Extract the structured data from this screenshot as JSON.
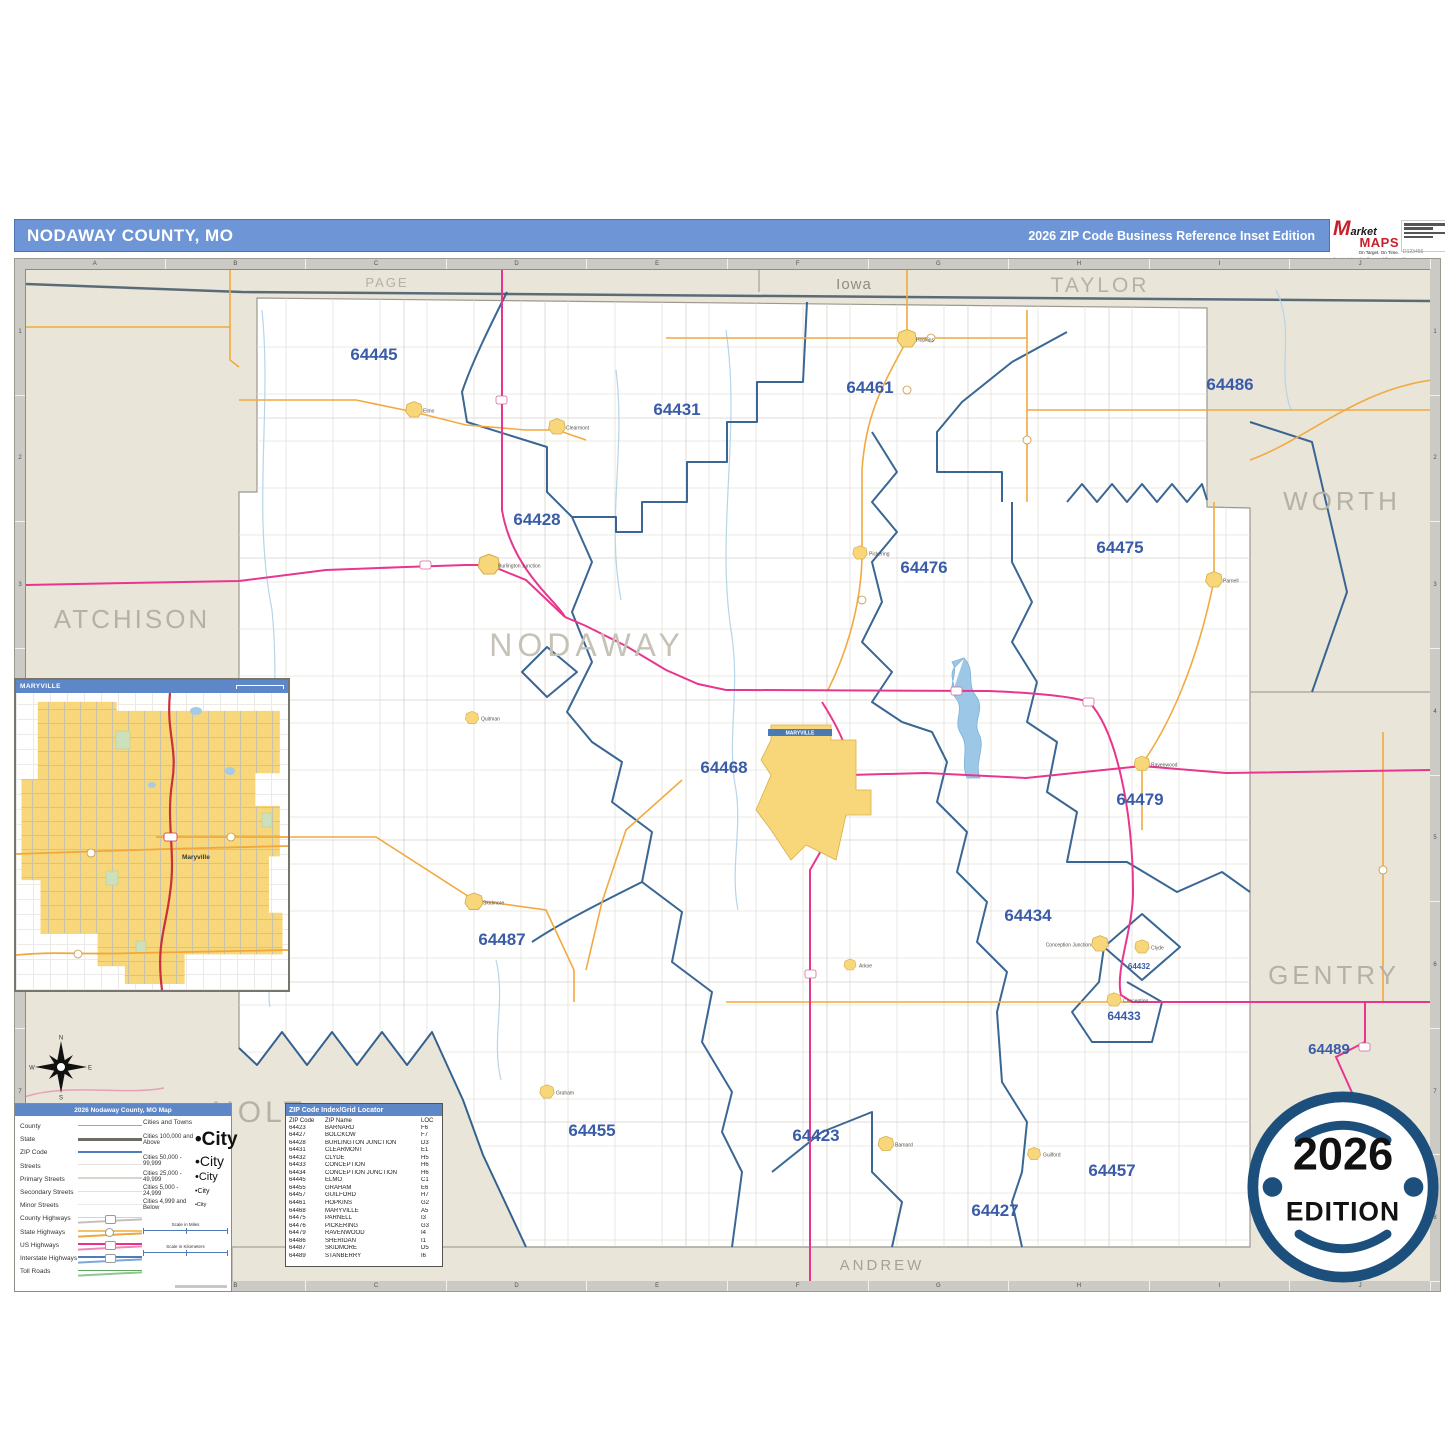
{
  "header": {
    "title": "NODAWAY COUNTY, MO",
    "edition": "2026 ZIP Code Business Reference Inset Edition",
    "logo": {
      "m": "M",
      "arket": "arket",
      "maps": "MAPS",
      "tagline": "On Target.  On Time.",
      "subline": "America's Leading Source of Business Maps",
      "order_code": "D123456"
    }
  },
  "ruler": {
    "letters": [
      "A",
      "B",
      "C",
      "D",
      "E",
      "F",
      "G",
      "H",
      "I",
      "J"
    ],
    "numbers": [
      "1",
      "2",
      "3",
      "4",
      "5",
      "6",
      "7",
      "8"
    ]
  },
  "map": {
    "maryville_label": "MARYVILLE",
    "county_labels": [
      {
        "text": "PAGE",
        "x": 361,
        "y": 17,
        "size": 13,
        "color": "#B5B1A5",
        "ls": 2
      },
      {
        "text": "Iowa",
        "x": 828,
        "y": 19,
        "size": 15,
        "color": "#8F8C83",
        "ls": 1
      },
      {
        "text": "TAYLOR",
        "x": 1074,
        "y": 22,
        "size": 21,
        "color": "#B5B1A5",
        "ls": 3
      },
      {
        "text": "WORTH",
        "x": 1316,
        "y": 240,
        "size": 26,
        "color": "#B5B1A5",
        "ls": 4
      },
      {
        "text": "ATCHISON",
        "x": 106,
        "y": 358,
        "size": 26,
        "color": "#B5B1A5",
        "ls": 3
      },
      {
        "text": "NODAWAY",
        "x": 561,
        "y": 386,
        "size": 32,
        "color": "#C6C2B6",
        "ls": 5
      },
      {
        "text": "GENTRY",
        "x": 1308,
        "y": 714,
        "size": 26,
        "color": "#B5B1A5",
        "ls": 4
      },
      {
        "text": "HOLT",
        "x": 233,
        "y": 852,
        "size": 30,
        "color": "#B5B1A5",
        "ls": 4
      },
      {
        "text": "ANDREW",
        "x": 856,
        "y": 1000,
        "size": 15,
        "color": "#A5A196",
        "ls": 3
      }
    ],
    "zip_labels": [
      {
        "code": "64445",
        "x": 348,
        "y": 90,
        "size": 17
      },
      {
        "code": "64431",
        "x": 651,
        "y": 145,
        "size": 17
      },
      {
        "code": "64461",
        "x": 844,
        "y": 123,
        "size": 17
      },
      {
        "code": "64486",
        "x": 1204,
        "y": 120,
        "size": 17
      },
      {
        "code": "64428",
        "x": 511,
        "y": 255,
        "size": 17
      },
      {
        "code": "64476",
        "x": 898,
        "y": 303,
        "size": 17
      },
      {
        "code": "64475",
        "x": 1094,
        "y": 283,
        "size": 17
      },
      {
        "code": "64468",
        "x": 698,
        "y": 503,
        "size": 17
      },
      {
        "code": "64479",
        "x": 1114,
        "y": 535,
        "size": 17
      },
      {
        "code": "64487",
        "x": 476,
        "y": 675,
        "size": 17
      },
      {
        "code": "64434",
        "x": 1002,
        "y": 651,
        "size": 17
      },
      {
        "code": "64432",
        "x": 1113,
        "y": 699,
        "size": 8
      },
      {
        "code": "64433",
        "x": 1098,
        "y": 750,
        "size": 12
      },
      {
        "code": "64489",
        "x": 1303,
        "y": 784,
        "size": 15
      },
      {
        "code": "64455",
        "x": 566,
        "y": 866,
        "size": 17
      },
      {
        "code": "64423",
        "x": 790,
        "y": 871,
        "size": 17
      },
      {
        "code": "64457",
        "x": 1086,
        "y": 906,
        "size": 17
      },
      {
        "code": "64427",
        "x": 969,
        "y": 946,
        "size": 17
      }
    ],
    "towns": [
      {
        "name": "Hopkins",
        "x": 881,
        "y": 69,
        "s": 1.6
      },
      {
        "name": "Elmo",
        "x": 388,
        "y": 140,
        "s": 1.4
      },
      {
        "name": "Clearmont",
        "x": 531,
        "y": 157,
        "s": 1.4
      },
      {
        "name": "Burlington Junction",
        "x": 463,
        "y": 295,
        "s": 1.8
      },
      {
        "name": "Quitman",
        "x": 446,
        "y": 448,
        "s": 1.1
      },
      {
        "name": "Pickering",
        "x": 834,
        "y": 283,
        "s": 1.2
      },
      {
        "name": "Parnell",
        "x": 1188,
        "y": 310,
        "s": 1.4
      },
      {
        "name": "Ravenwood",
        "x": 1116,
        "y": 494,
        "s": 1.3
      },
      {
        "name": "Skidmore",
        "x": 448,
        "y": 632,
        "s": 1.5
      },
      {
        "name": "Arkoe",
        "x": 824,
        "y": 695,
        "s": 1.0
      },
      {
        "name": "Conception Junction",
        "x": 1074,
        "y": 674,
        "s": 1.4,
        "side": "left"
      },
      {
        "name": "Clyde",
        "x": 1116,
        "y": 677,
        "s": 1.2
      },
      {
        "name": "Conception",
        "x": 1088,
        "y": 730,
        "s": 1.2
      },
      {
        "name": "Graham",
        "x": 521,
        "y": 822,
        "s": 1.2
      },
      {
        "name": "Barnard",
        "x": 860,
        "y": 874,
        "s": 1.3
      },
      {
        "name": "Guilford",
        "x": 1008,
        "y": 884,
        "s": 1.1
      }
    ]
  },
  "inset": {
    "title": "MARYVILLE",
    "city": "Maryville"
  },
  "legend": {
    "title": "2026 Nodaway County, MO Map",
    "line_items": [
      {
        "label": "County",
        "colors": [
          "#A9A69D"
        ],
        "thick": 1.5,
        "shield": "none"
      },
      {
        "label": "State",
        "colors": [
          "#6E6B64"
        ],
        "thick": 3,
        "shield": "none"
      },
      {
        "label": "ZIP Code",
        "colors": [
          "#4F7CB8"
        ],
        "thick": 2,
        "shield": "none"
      },
      {
        "label": "Streets",
        "colors": [
          "#E2E0DA"
        ],
        "thick": 1,
        "shield": "none"
      },
      {
        "label": "Primary Streets",
        "colors": [
          "#D8D5CE"
        ],
        "thick": 1.5,
        "shield": "none"
      },
      {
        "label": "Secondary Streets",
        "colors": [
          "#E2E0DA"
        ],
        "thick": 1,
        "shield": "none"
      },
      {
        "label": "Minor Streets",
        "colors": [
          "#EBE9E3"
        ],
        "thick": 1,
        "shield": "none"
      },
      {
        "label": "County Highways",
        "colors": [
          "#D5D2CB",
          "#C4C1BA"
        ],
        "thick": 1.5,
        "shield": "oval"
      },
      {
        "label": "State Highways",
        "colors": [
          "#F4C06A",
          "#F0A83C"
        ],
        "thick": 1.5,
        "shield": "circle"
      },
      {
        "label": "US Highways",
        "colors": [
          "#E8318A",
          "#F088B8"
        ],
        "thick": 1.8,
        "shield": "oval"
      },
      {
        "label": "Interstate Highways",
        "colors": [
          "#4F7CB8",
          "#7AA8D8"
        ],
        "thick": 1.8,
        "shield": "oval"
      },
      {
        "label": "Toll Roads",
        "colors": [
          "#5FA85F",
          "#8FC88F"
        ],
        "thick": 1.5,
        "shield": "none"
      }
    ],
    "cities_header": "Cities and Towns",
    "city_classes": [
      {
        "label": "Cities 100,000 and Above",
        "word": "City",
        "size": 19,
        "bold": true
      },
      {
        "label": "Cities 50,000 - 99,999",
        "word": "City",
        "size": 14,
        "bold": false
      },
      {
        "label": "Cities 25,000 - 49,999",
        "word": "City",
        "size": 11,
        "bold": false
      },
      {
        "label": "Cities 5,000 - 24,999",
        "word": "City",
        "size": 7,
        "bold": false
      },
      {
        "label": "Cities 4,999 and Below",
        "word": "City",
        "size": 5.5,
        "bold": false
      }
    ],
    "scale_miles": "Scale in Miles",
    "scale_km": "Scale in Kilometers"
  },
  "zip_table": {
    "title": "ZIP Code Index/Grid Locator",
    "columns": [
      "ZIP Code",
      "ZIP Name",
      "LOC"
    ],
    "rows": [
      [
        "64423",
        "BARNARD",
        "F6"
      ],
      [
        "64427",
        "BOLCKOW",
        "F7"
      ],
      [
        "64428",
        "BURLINGTON JUNCTION",
        "D3"
      ],
      [
        "64431",
        "CLEARMONT",
        "E1"
      ],
      [
        "64432",
        "CLYDE",
        "H5"
      ],
      [
        "64433",
        "CONCEPTION",
        "H6"
      ],
      [
        "64434",
        "CONCEPTION JUNCTION",
        "H6"
      ],
      [
        "64445",
        "ELMO",
        "C1"
      ],
      [
        "64455",
        "GRAHAM",
        "E6"
      ],
      [
        "64457",
        "GUILFORD",
        "H7"
      ],
      [
        "64461",
        "HOPKINS",
        "G2"
      ],
      [
        "64468",
        "MARYVILLE",
        "A5"
      ],
      [
        "64475",
        "PARNELL",
        "I3"
      ],
      [
        "64476",
        "PICKERING",
        "G3"
      ],
      [
        "64479",
        "RAVENWOOD",
        "I4"
      ],
      [
        "64486",
        "SHERIDAN",
        "I1"
      ],
      [
        "64487",
        "SKIDMORE",
        "D5"
      ],
      [
        "64489",
        "STANBERRY",
        "I6"
      ]
    ]
  },
  "badge": {
    "year": "2026",
    "word": "EDITION",
    "color": "#1C4F7C"
  },
  "compass": {
    "n": "N",
    "e": "E",
    "s": "S",
    "w": "W"
  }
}
